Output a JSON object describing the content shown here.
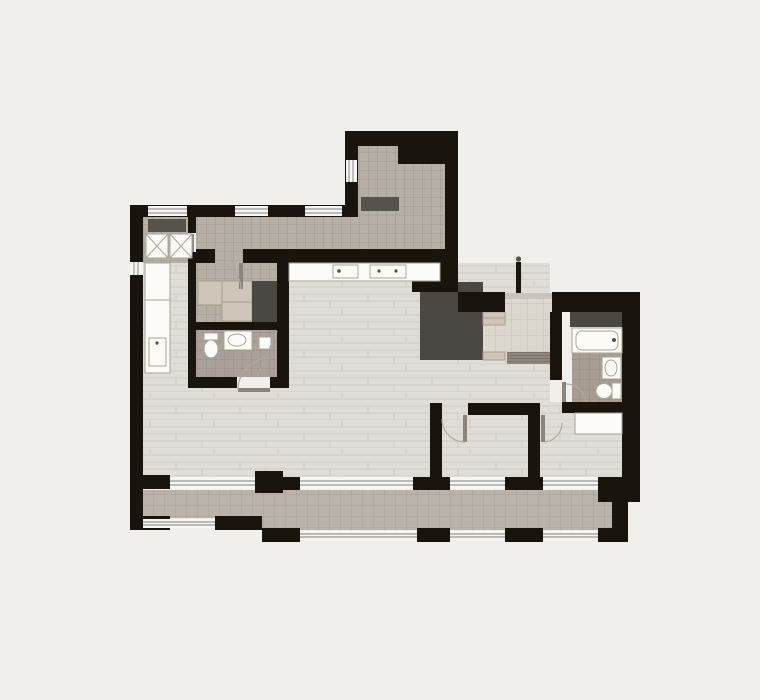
{
  "meta": {
    "type": "apartment-floor-plan",
    "description": "Top-down architectural floor plan of an apartment with entry vestibule, hallway, laundry balcony, kitchen, dressing room, two bathrooms, living-dining area, two bedrooms and two lower balconies"
  },
  "colors": {
    "background": "#f1efeb",
    "wall": "#1a140e",
    "wood": "#e0ddd8",
    "wood_line": "#cecbc5",
    "tile": "#b6afa6",
    "tile_line": "#a29a90",
    "balcony": "#bab3ab",
    "balcony_line": "#a9a299",
    "entry_tile": "#dcd7ce",
    "entry_tile_line": "#c6c0b5",
    "bath_tile": "#a9a199",
    "bath_tile_line": "#968e84",
    "bath2_tile": "#a89d93",
    "bath2_tile_line": "#978d82",
    "furniture_dark": "#4b4844",
    "furniture_beige": "#cdc6b9",
    "furniture_beige_border": "#a79d8d",
    "fixture": "#fbfaf7",
    "fixture_border": "#aaa49a",
    "glass": "#f6f5f2",
    "glass_line": "#a7a7a4",
    "doormat": "#8f877d",
    "doormat_line": "#7b7369",
    "shelf_dark": "#56524c",
    "door_leaf": "#8a847c",
    "arc": "#b0a99f",
    "threshold": "#c9c4bb"
  },
  "rooms": [
    "entry-vestibule",
    "hallway",
    "laundry-balcony",
    "kitchen",
    "dressing-room",
    "bathroom-small",
    "bathroom-main",
    "living-dining",
    "bedroom-middle",
    "bedroom-right",
    "balcony-left",
    "balcony-right"
  ],
  "fixtures": [
    "washing-machine",
    "dryer",
    "kitchen-counter",
    "kitchen-sink",
    "cooktop",
    "wardrobe-unit",
    "closet-block",
    "toilet",
    "washbasin",
    "shower",
    "bathtub",
    "entry-door",
    "doormat",
    "bed-desk",
    "storage-niche"
  ]
}
